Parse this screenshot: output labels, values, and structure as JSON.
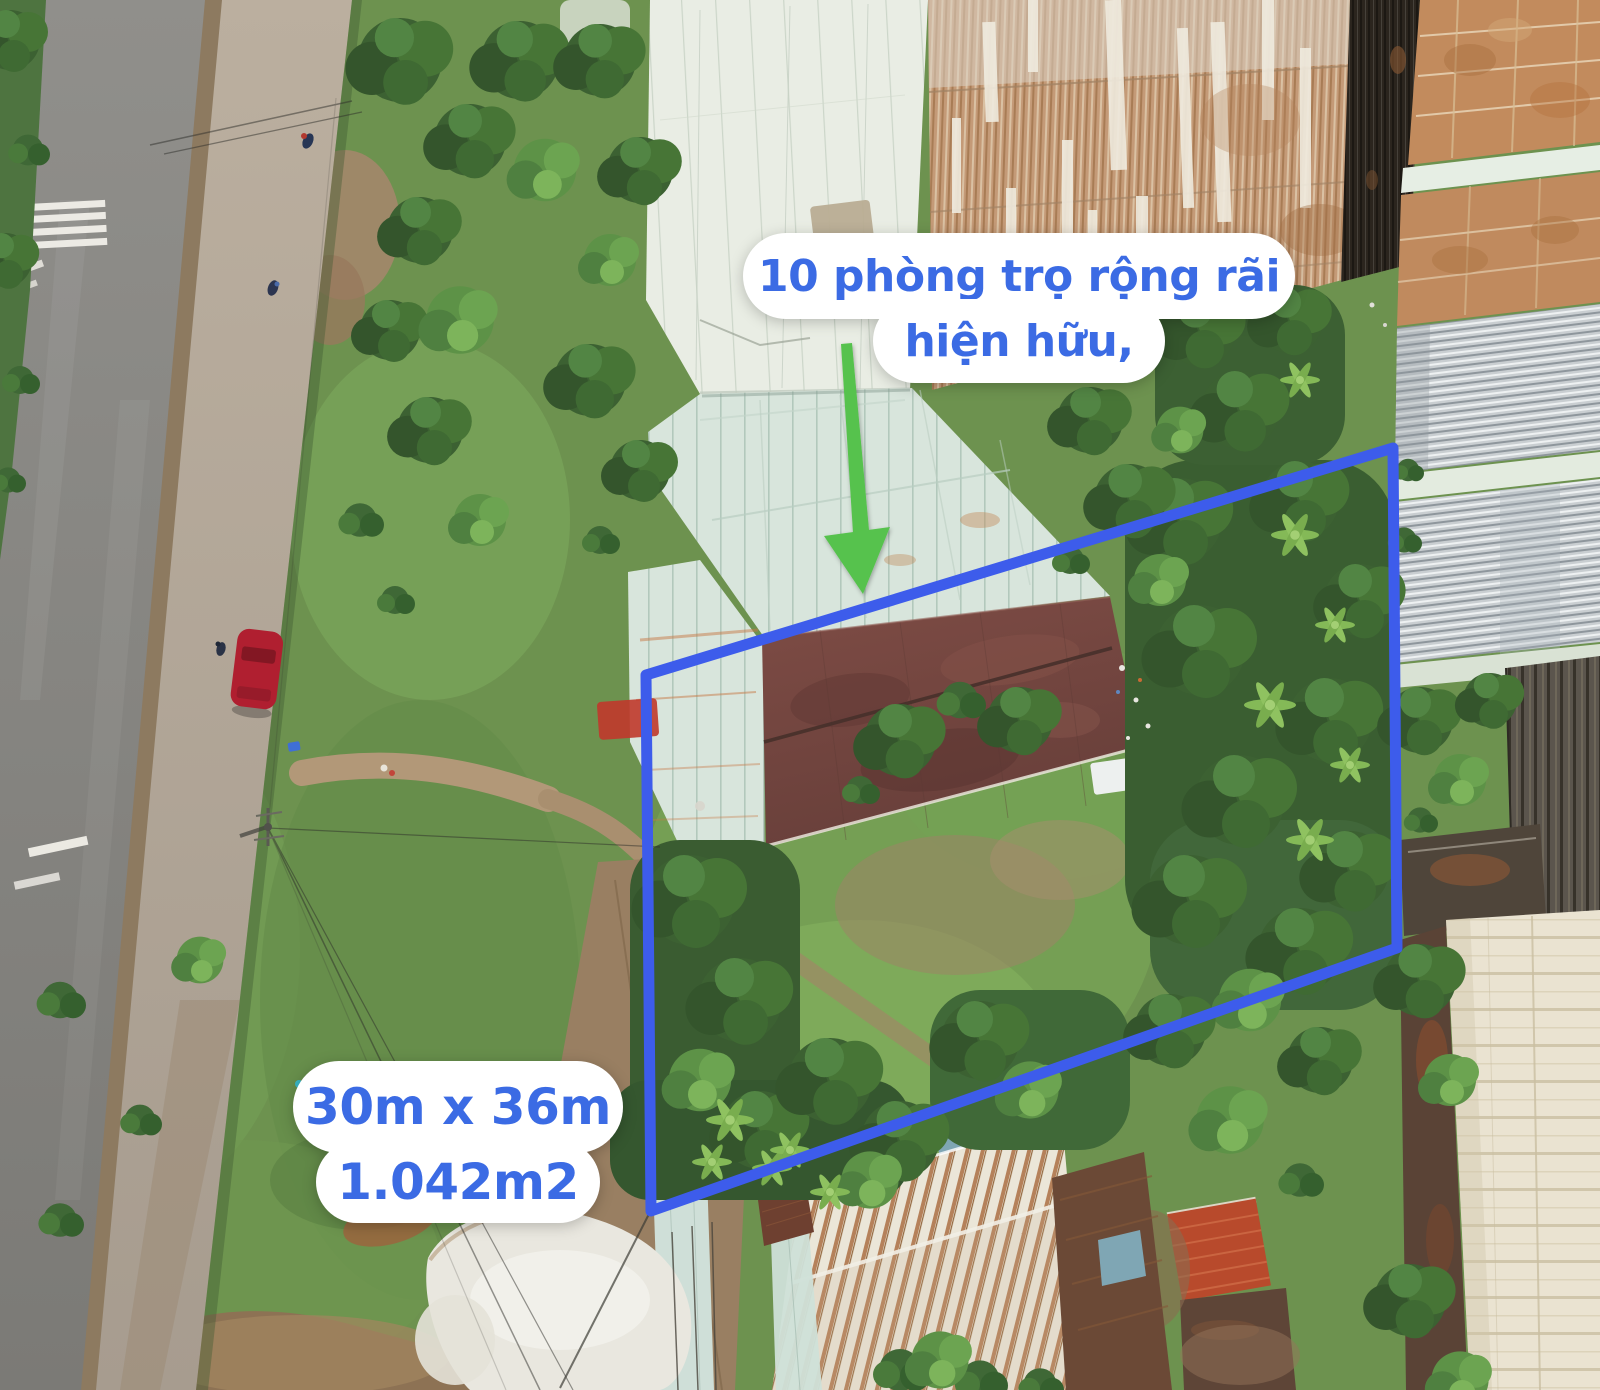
{
  "image": {
    "type": "aerial-drone-photo",
    "description": "Top-down drone photo of a land plot for sale beside a two-lane road; plot boundary outlined in blue, green arrow pointing at an existing row of rental rooms",
    "width_px": 1600,
    "height_px": 1390
  },
  "annotations": {
    "callout_rooms": {
      "line1": "10 phòng trọ rộng rãi",
      "line2": "hiện hữu,"
    },
    "callout_size": {
      "line1": "30m x 36m",
      "line2": "1.042m2"
    },
    "text_color": "#3b6be4",
    "bubble_color": "#ffffff"
  },
  "boundary": {
    "color": "#3d5ceb",
    "stroke_width": 11,
    "points": "646,675 1393,448 1397,948 651,1211"
  },
  "arrow": {
    "color": "#56c24d",
    "shaft_points": "841,344 852,343 869,530 853,533",
    "head_points": "824,536 890,527 863,594"
  }
}
